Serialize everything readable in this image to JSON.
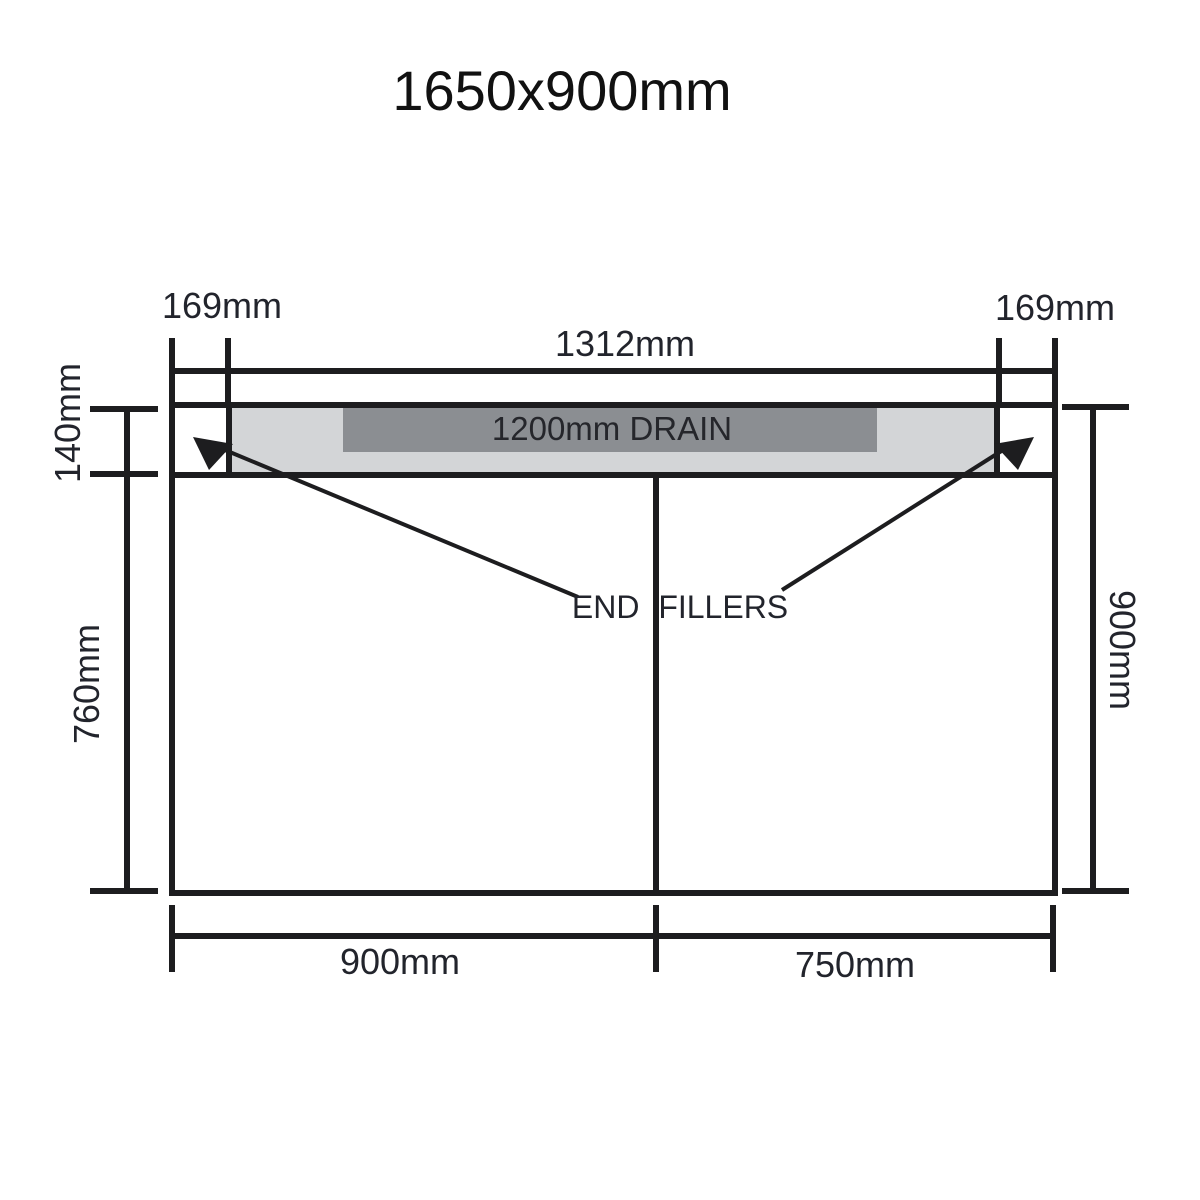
{
  "title": "1650x900mm",
  "labels": {
    "drain": "1200mm DRAIN",
    "end_fillers": "END FILLERS"
  },
  "dimensions": {
    "top_left_offset": "169mm",
    "top_right_offset": "169mm",
    "top_span": "1312mm",
    "drain_depth": "140mm",
    "lower_height": "760mm",
    "overall_height": "900mm",
    "bottom_left_span": "900mm",
    "bottom_right_span": "750mm"
  },
  "colors": {
    "line": "#1d1d1f",
    "drain_light": "#d3d5d7",
    "drain_dark": "#8b8e92",
    "text": "#22242c"
  }
}
